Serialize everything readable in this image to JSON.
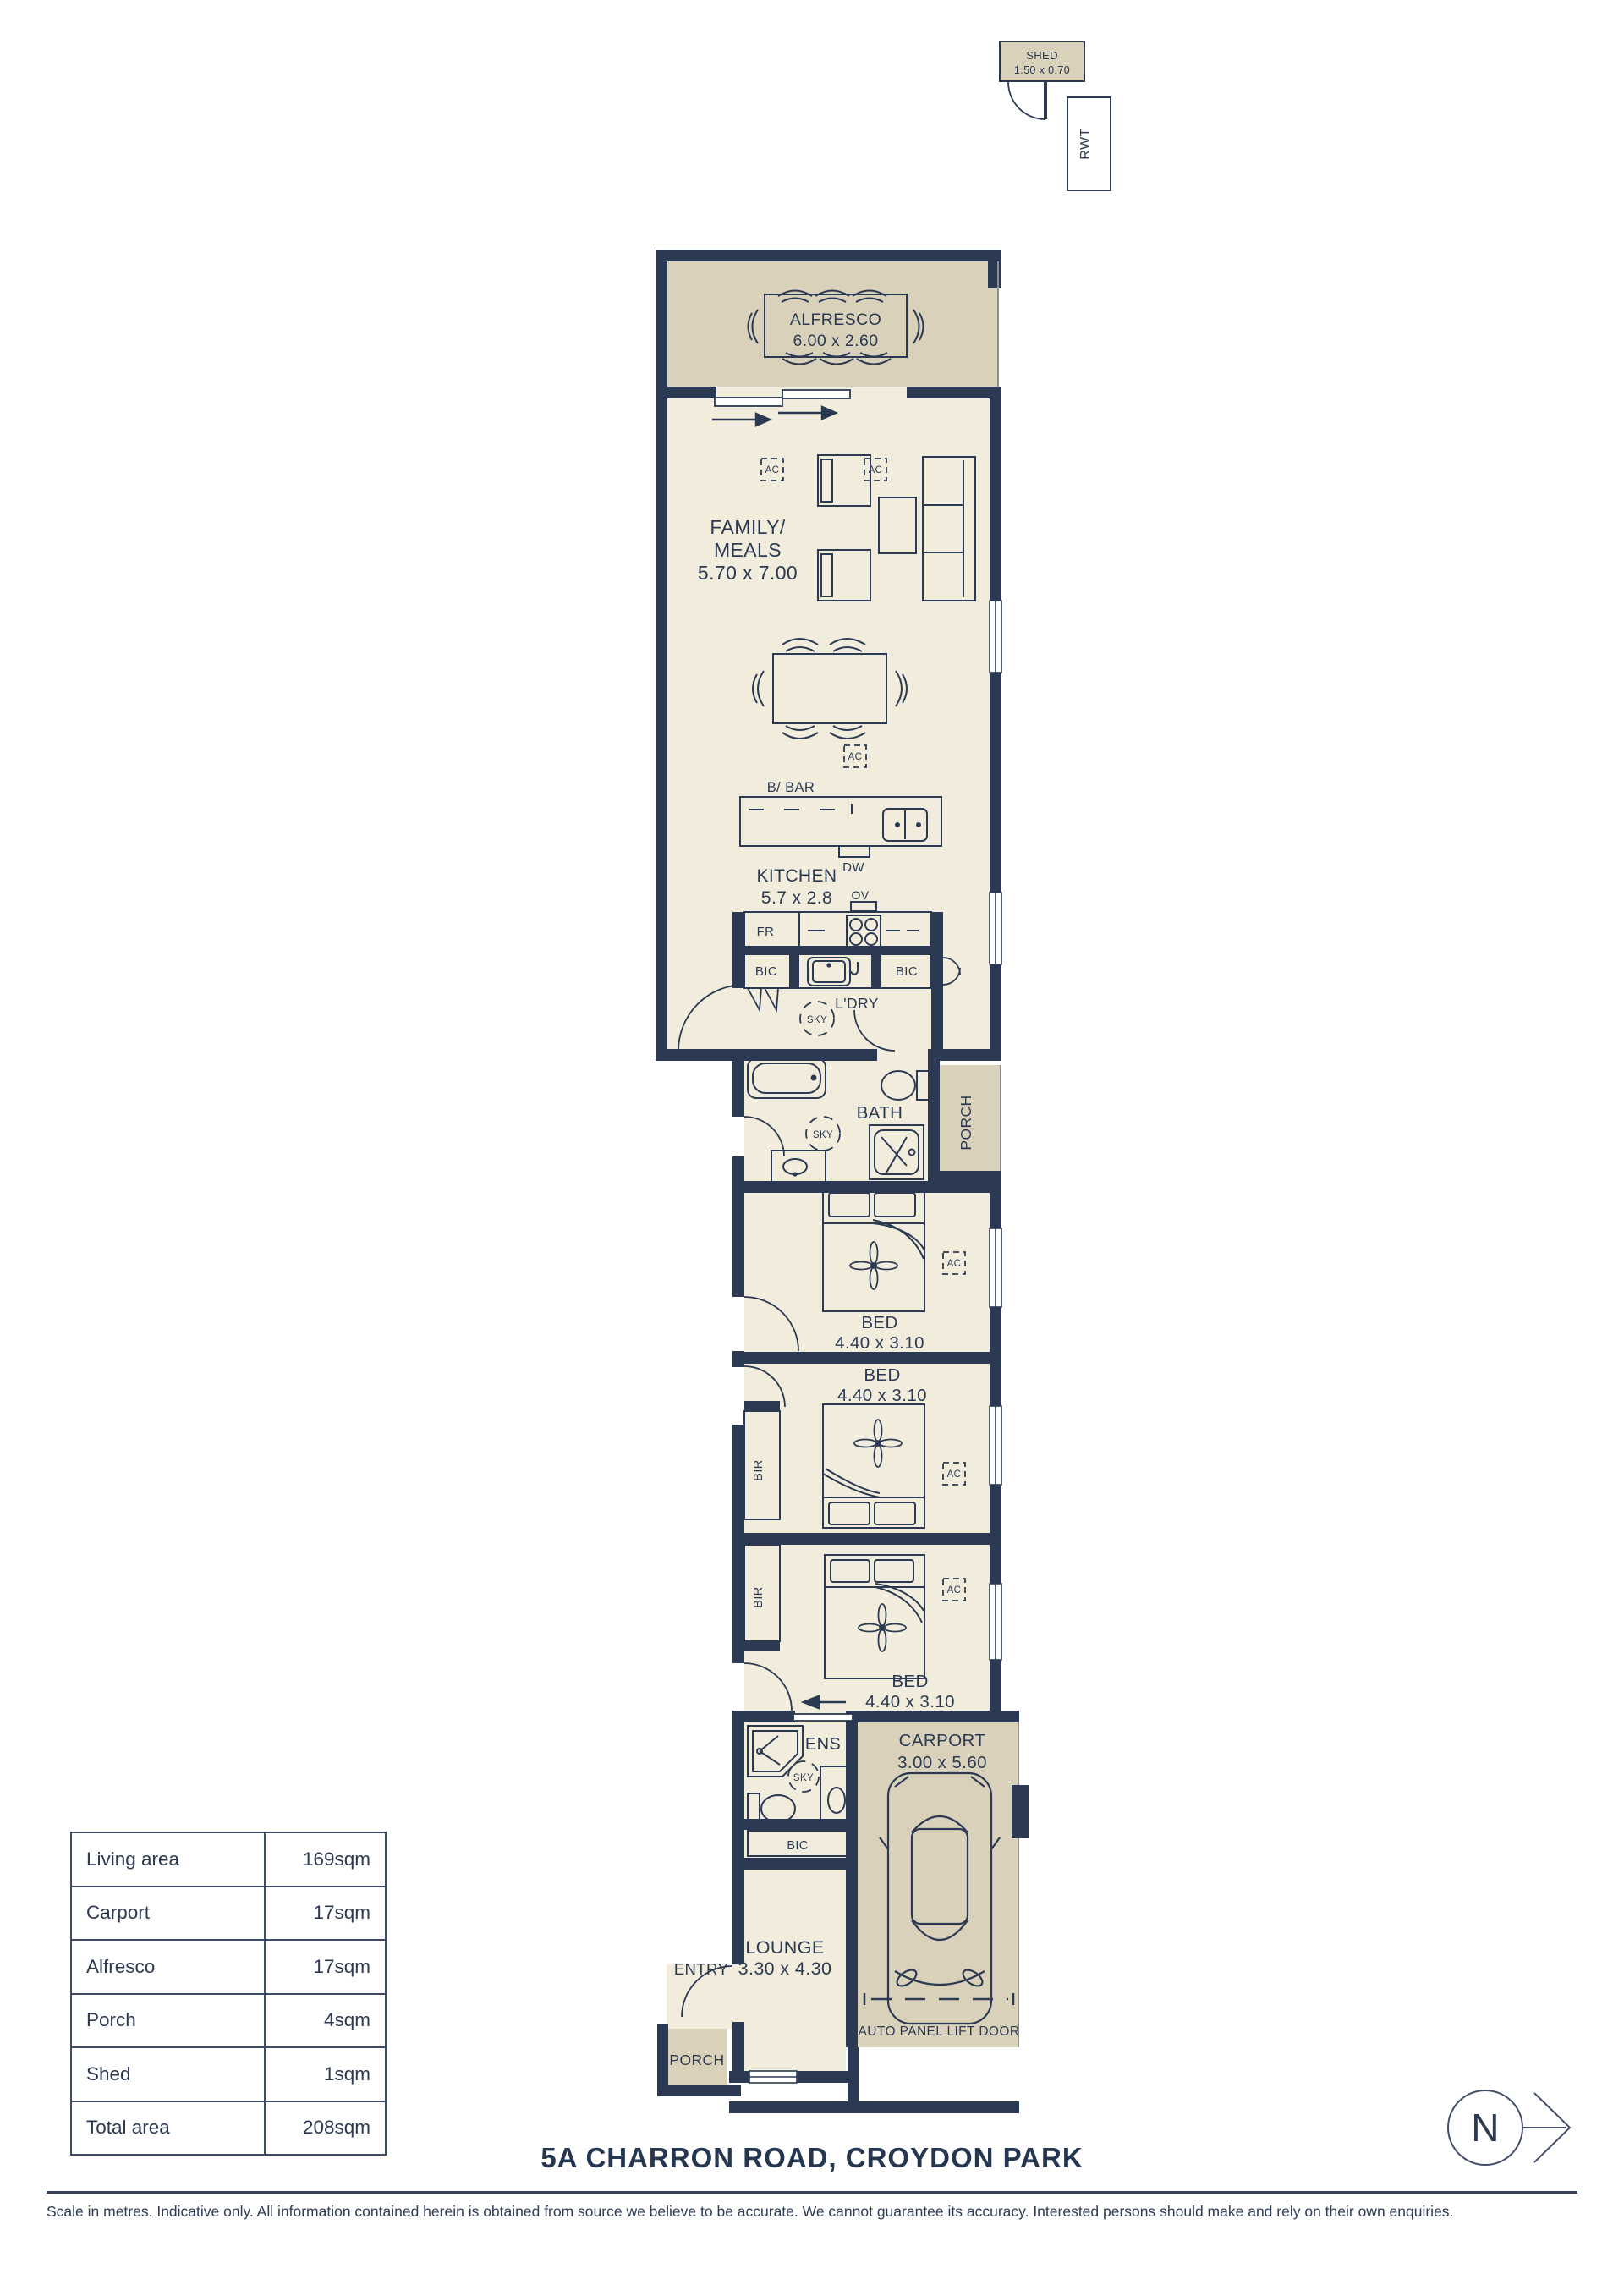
{
  "colors": {
    "wall_navy": "#2b3a52",
    "interior_cream": "#f2ecdc",
    "outdoor_tan": "#d9d1ba",
    "text_navy": "#2b3a52"
  },
  "labels": {
    "shed_name": "SHED",
    "shed_dims": "1.50 x 0.70",
    "rwt": "RWT",
    "alfresco_name": "ALFRESCO",
    "alfresco_dims": "6.00 x 2.60",
    "family_line1": "FAMILY/",
    "family_line2": "MEALS",
    "family_dims": "5.70 x 7.00",
    "ac": "AC",
    "bbar": "B/ BAR",
    "dw": "DW",
    "kitchen_name": "KITCHEN",
    "kitchen_dims": "5.7 x 2.8",
    "ov": "OV",
    "fr": "FR",
    "bic": "BIC",
    "ldry": "L'DRY",
    "sky": "SKY",
    "bath": "BATH",
    "porch": "PORCH",
    "bed_name": "BED",
    "bed_dims": "4.40 x 3.10",
    "bir": "BIR",
    "ens": "ENS",
    "carport_name": "CARPORT",
    "carport_dims": "3.00 x 5.60",
    "auto_door": "AUTO PANEL LIFT DOOR",
    "lounge_name": "LOUNGE",
    "lounge_dims": "3.30 x 4.30",
    "entry": "ENTRY",
    "north": "N"
  },
  "areas_table": {
    "rows": [
      {
        "label": "Living area",
        "value": "169sqm"
      },
      {
        "label": "Carport",
        "value": "17sqm"
      },
      {
        "label": "Alfresco",
        "value": "17sqm"
      },
      {
        "label": "Porch",
        "value": "4sqm"
      },
      {
        "label": "Shed",
        "value": "1sqm"
      },
      {
        "label": "Total area",
        "value": "208sqm"
      }
    ]
  },
  "footer": {
    "address": "5A CHARRON ROAD, CROYDON PARK",
    "disclaimer": "Scale in metres. Indicative only. All information contained herein is obtained from source we believe to be accurate. We cannot guarantee its accuracy. Interested persons should make and rely on their own enquiries."
  }
}
